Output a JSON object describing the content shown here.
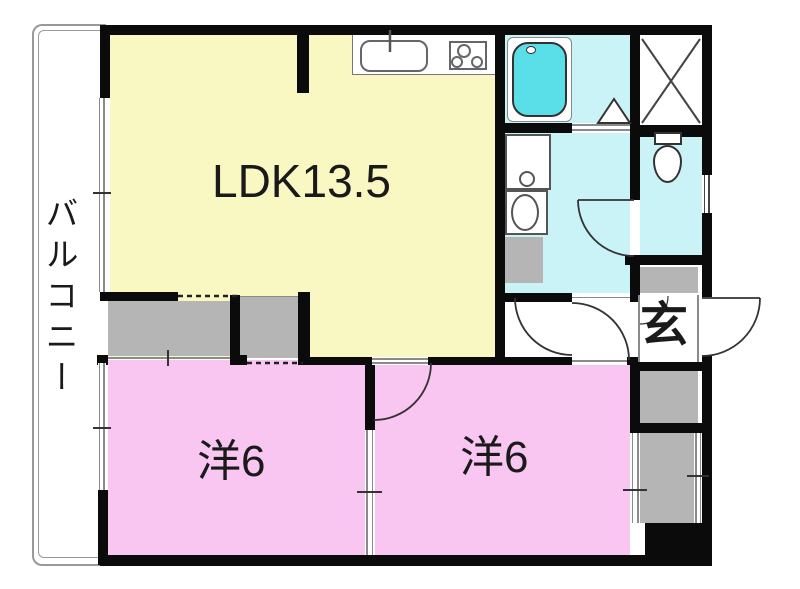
{
  "plan": {
    "type": "apartment-floor-plan",
    "labels": {
      "ldk": "LDK13.5",
      "room1": "洋6",
      "room2": "洋6",
      "entrance": "玄",
      "balcony": "バルコニー"
    },
    "rooms": [
      {
        "id": "ldk",
        "label": "LDK13.5",
        "meaning": "living-dining-kitchen 13.5 mats",
        "color": "#faf8c2"
      },
      {
        "id": "western-room-1",
        "label": "洋6",
        "meaning": "western room 6 mats",
        "color": "#f8c6f0"
      },
      {
        "id": "western-room-2",
        "label": "洋6",
        "meaning": "western room 6 mats",
        "color": "#f8c6f0"
      },
      {
        "id": "bathroom",
        "label": "",
        "meaning": "bath",
        "color": "#c9f3f7"
      },
      {
        "id": "washroom",
        "label": "",
        "meaning": "washroom",
        "color": "#c9f3f7"
      },
      {
        "id": "toilet",
        "label": "",
        "meaning": "toilet",
        "color": "#c9f3f7"
      },
      {
        "id": "entrance",
        "label": "玄",
        "meaning": "genkan entrance",
        "color": "#ffffff"
      },
      {
        "id": "balcony",
        "label": "バルコニー",
        "meaning": "balcony",
        "color": "#ffffff"
      }
    ],
    "fixtures": [
      "kitchen-sink",
      "gas-stove",
      "bathtub",
      "vanity-basin",
      "washing-machine",
      "toilet-bowl",
      "closet",
      "shoe-cabinet",
      "pipe-space"
    ],
    "colors": {
      "wall": "#0b0b0b",
      "ldk": "#faf8c2",
      "room": "#f8c6f0",
      "wet-area": "#c9f3f7",
      "bathtub": "#5adfe9",
      "storage-gray": "#b5b5b5",
      "thin-line": "#8a8a8a",
      "text": "#1a1a1a"
    }
  }
}
